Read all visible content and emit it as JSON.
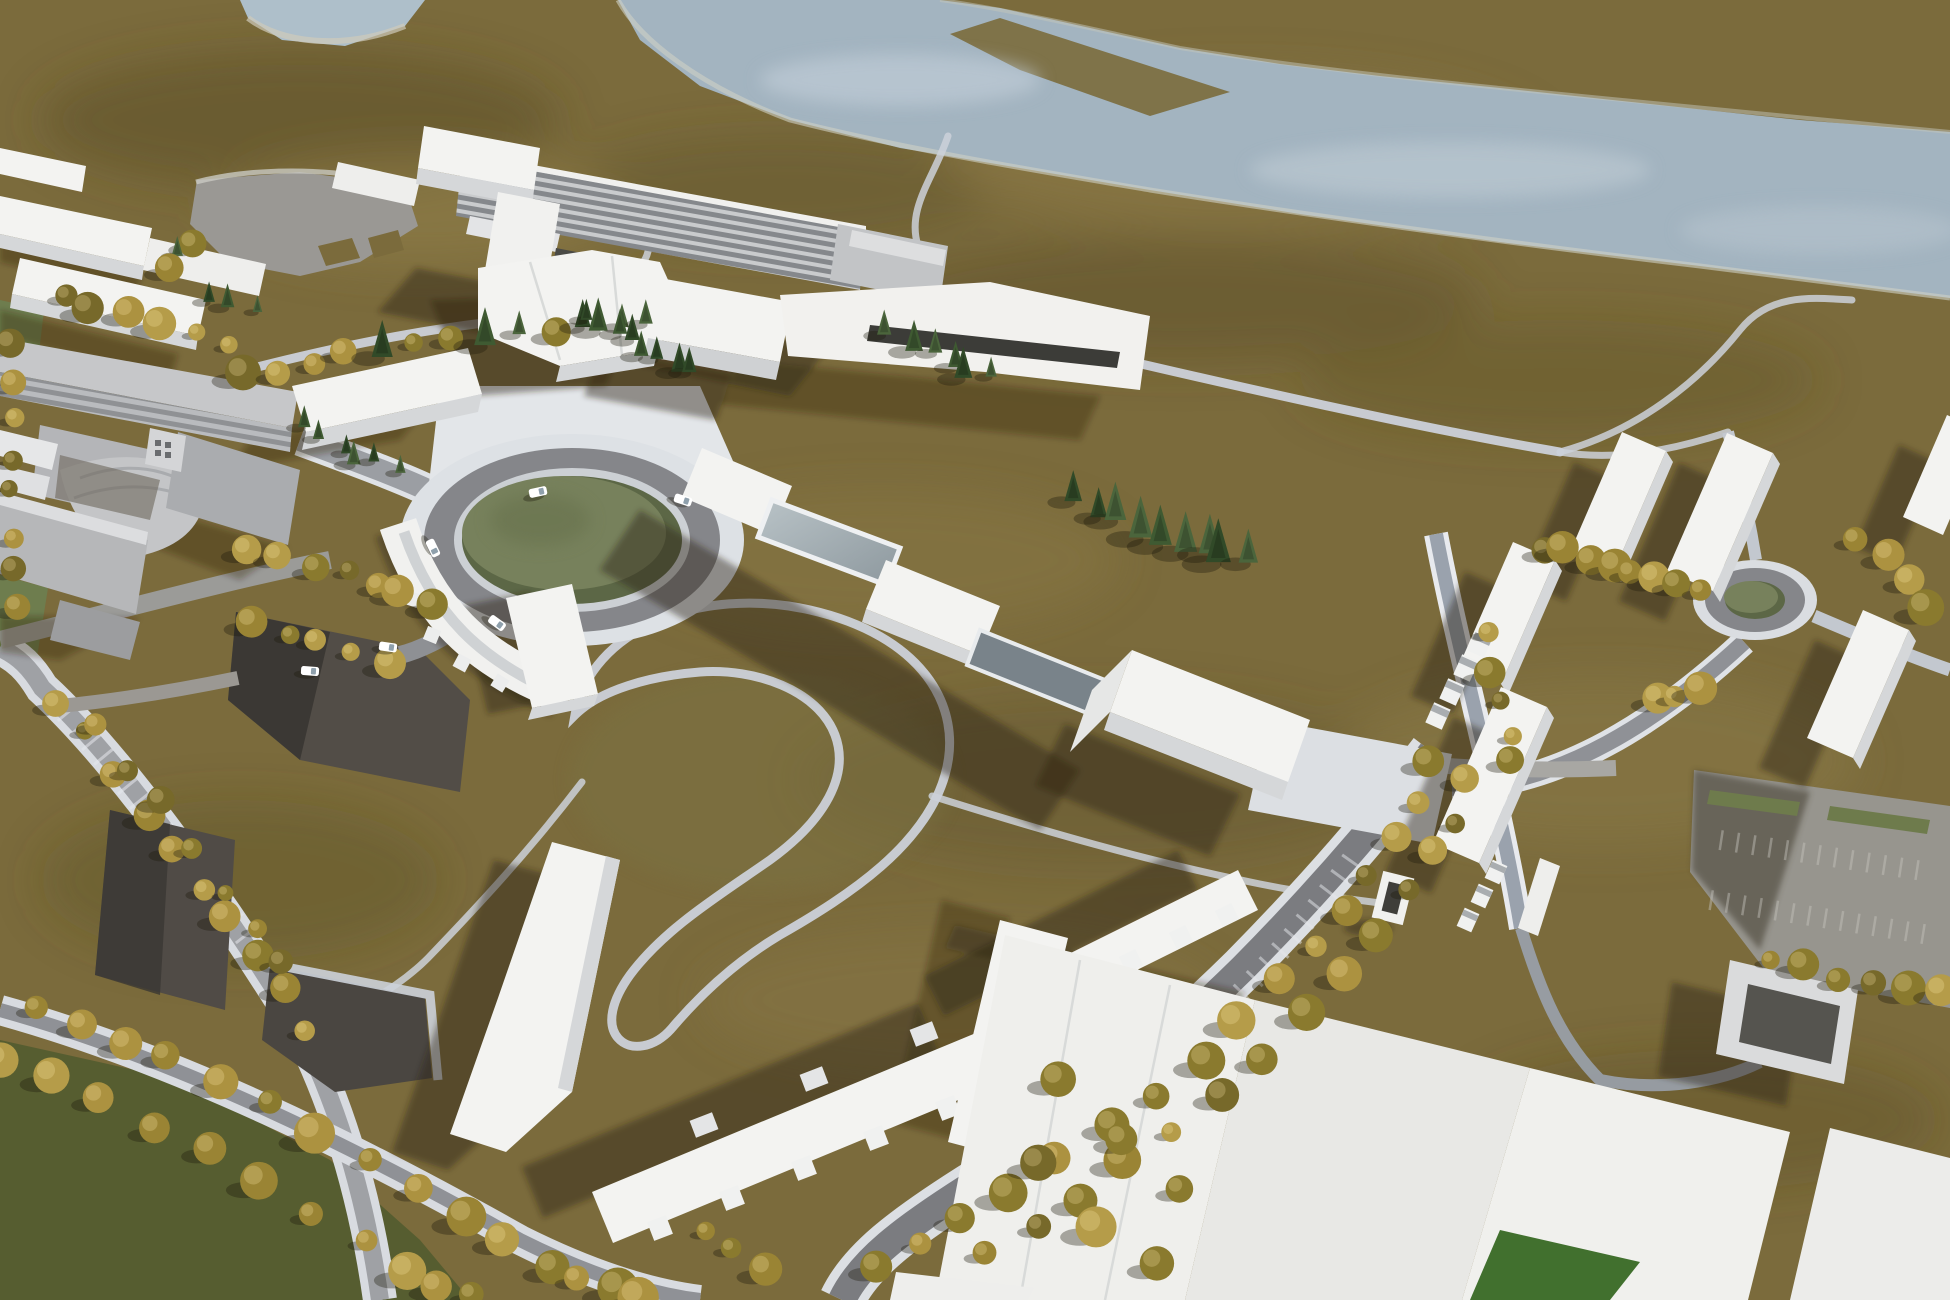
{
  "meta": {
    "type": "aerial-3d-architectural-masterplan-rendering",
    "description": "Bird's-eye 3D visualization of a campus masterplan: white massing-model buildings on olive-brown terrain, a grey-blue river across the top, a large landscaped traffic roundabout at center-left, a long linear laboratory building with striped facade at top-center, tree-lined curving streets, dark parking lots lower-left, a secondary small roundabout and building cluster at right, and large white building plates at bottom-right. No text is visible in the image."
  },
  "palette": {
    "terrain": "#7b6b3c",
    "terrain_dark": "#584c24",
    "terrain_light": "#9a8851",
    "river": "#a3b4c0",
    "river_light": "#c3cfd8",
    "river_bank": "#cfd0c4",
    "path_white": "#ccd1d9",
    "asphalt": "#85868a",
    "asphalt_dark": "#6f7073",
    "street_blue": "#9aa2ad",
    "parking_dark": "#524d47",
    "parking_grey": "#97958e",
    "plaza_white": "#dcdfe3",
    "building_white": "#f3f3f1",
    "building_face": "#d5d7d9",
    "campus_grey": "#c6c7c9",
    "lab_stripe_light": "#c9cbcd",
    "lab_stripe_dark": "#85888c",
    "glass": "#9aa6ac",
    "glass_dark": "#79838a",
    "roundabout_green": "#77815c",
    "roundabout_green_dark": "#5c6746",
    "field_green": "#6e7d4e",
    "lawn_dark": "#565d30",
    "courtyard_green": "#41702e",
    "pond_grey": "#9a9894",
    "shadow": "#2c2512",
    "car_body": "#ffffff",
    "car_glass": "#8fa0ac",
    "tree_autumn": [
      "#9a8434",
      "#8a7a2e",
      "#ac9240",
      "#77692a",
      "#b59c49"
    ],
    "tree_conifer": [
      "#3f5a32",
      "#314a28",
      "#4b653c"
    ]
  },
  "scene": {
    "landmarks": [
      "river",
      "top-left-pond",
      "grey-retention-pond",
      "linear-laboratory-building",
      "central-hub-building",
      "main-roundabout",
      "secondary-roundabout",
      "curved-residential-row",
      "articulated-housing-rows",
      "right-building-cluster",
      "right-parking-lot",
      "bottom-right-building-plates",
      "dark-parking-lots",
      "tree-lined-avenues",
      "sports-fields",
      "existing-campus-grey-buildings"
    ],
    "main_roundabout": {
      "cx": 572,
      "cy": 540,
      "green_rx": 110,
      "green_ry": 64
    },
    "secondary_roundabout": {
      "cx": 1755,
      "cy": 600,
      "green_rx": 30,
      "green_ry": 19
    },
    "tree_lines": [
      {
        "id": "pond-row",
        "type": "m",
        "pts": "250,378 340,352 450,338 560,328 648,320",
        "n": 13,
        "r": 13
      },
      {
        "id": "field-edge",
        "type": "a",
        "pts": "62,300 140,318 228,342",
        "n": 6,
        "r": 12
      },
      {
        "id": "left-edge",
        "type": "a",
        "pts": "16,345 10,430 8,520 14,610",
        "n": 8,
        "r": 11
      },
      {
        "id": "lab-conifers",
        "type": "c",
        "pts": "585,318 640,342 692,368",
        "n": 8,
        "r": 13
      },
      {
        "id": "hub-east-conifers",
        "type": "c",
        "pts": "1078,500 1135,522 1190,542 1245,558",
        "n": 9,
        "r": 15
      },
      {
        "id": "cluster-north-row",
        "type": "a",
        "pts": "1543,545 1598,558 1652,572 1705,585",
        "n": 8,
        "r": 13
      },
      {
        "id": "roundabout2-ne",
        "type": "a",
        "pts": "1850,540 1900,570 1930,610",
        "n": 4,
        "r": 14
      },
      {
        "id": "avenue-west",
        "type": "a",
        "pts": "1432,764 1398,828 1348,900 1290,968 1223,1040 1138,1108 1046,1170 956,1222 880,1262",
        "n": 16,
        "r": 14
      },
      {
        "id": "avenue-east",
        "type": "a",
        "pts": "1470,780 1436,850 1384,924 1320,1000 1248,1072 1160,1140 1072,1200 990,1252",
        "n": 14,
        "r": 14
      },
      {
        "id": "south-avenue-1",
        "type": "a",
        "pts": "40,1002 160,1052 300,1122 440,1202 560,1266 640,1300",
        "n": 15,
        "r": 15
      },
      {
        "id": "south-avenue-2",
        "type": "a",
        "pts": "6,1058 120,1108 260,1180 400,1262 470,1300",
        "n": 11,
        "r": 14
      },
      {
        "id": "west-road-1",
        "type": "a",
        "pts": "60,700 120,780 190,868 252,948 304,1028",
        "n": 10,
        "r": 12
      },
      {
        "id": "west-road-2",
        "type": "a",
        "pts": "100,726 158,804 224,888 284,964",
        "n": 7,
        "r": 11
      },
      {
        "id": "lot1-edge",
        "type": "a",
        "pts": "252,620 322,642 392,662",
        "n": 5,
        "r": 12
      },
      {
        "id": "campus-road",
        "type": "a",
        "pts": "244,546 312,562 374,580 428,600",
        "n": 7,
        "r": 12
      },
      {
        "id": "pond-west",
        "type": "m",
        "pts": "206,298 252,308",
        "n": 3,
        "r": 11
      },
      {
        "id": "meadow-scatter",
        "type": "a",
        "pts": "1056,1082 1120,1142 1182,1192 1098,1228 1042,1168 1160,1258",
        "n": 6,
        "r": 16
      },
      {
        "id": "row-a-end",
        "type": "a",
        "pts": "704,1232 762,1268",
        "n": 3,
        "r": 13
      },
      {
        "id": "pond-west-2",
        "type": "m",
        "pts": "188,242 164,266",
        "n": 3,
        "r": 11
      },
      {
        "id": "street1-row",
        "type": "a",
        "pts": "1490,636 1502,700 1514,764",
        "n": 5,
        "r": 12
      },
      {
        "id": "south-conifers",
        "type": "c",
        "pts": "300,420 350,450 400,470",
        "n": 6,
        "r": 12
      },
      {
        "id": "lab-east-conifers",
        "type": "c",
        "pts": "890,330 940,355 985,378",
        "n": 6,
        "r": 11
      },
      {
        "id": "parking-south-row",
        "type": "a",
        "pts": "1770,960 1830,972 1890,984 1944,996",
        "n": 6,
        "r": 13
      },
      {
        "id": "roundabout2-west",
        "type": "a",
        "pts": "1660,700 1700,690",
        "n": 3,
        "r": 12
      }
    ],
    "cars": [
      {
        "x": 538,
        "y": 492,
        "a": -12
      },
      {
        "x": 683,
        "y": 500,
        "a": 18
      },
      {
        "x": 433,
        "y": 548,
        "a": 64
      },
      {
        "x": 497,
        "y": 623,
        "a": 36
      },
      {
        "x": 388,
        "y": 647,
        "a": 8
      },
      {
        "x": 310,
        "y": 671,
        "a": 4
      }
    ]
  }
}
